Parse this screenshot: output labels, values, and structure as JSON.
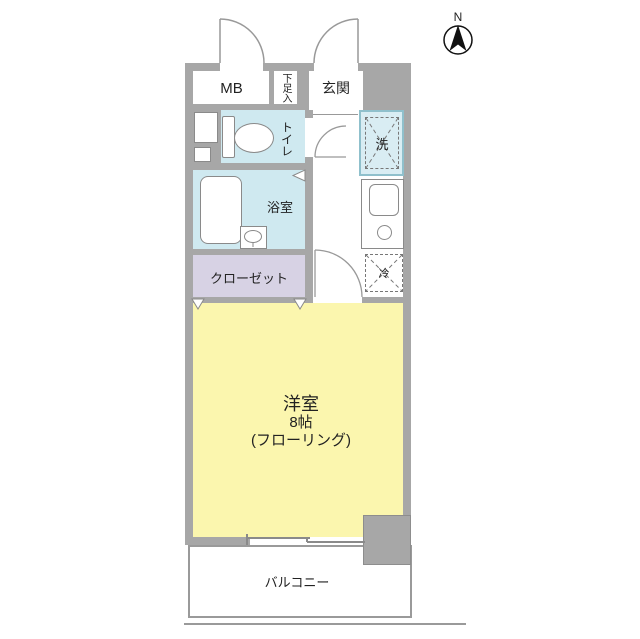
{
  "compass": {
    "north_label": "N"
  },
  "floor_plan": {
    "rooms": {
      "mb": {
        "label": "MB"
      },
      "shoe_box": {
        "label": "下足入"
      },
      "entrance": {
        "label": "玄関"
      },
      "toilet": {
        "label": "トイレ"
      },
      "bathroom": {
        "label": "浴室"
      },
      "laundry": {
        "label": "洗"
      },
      "refrigerator": {
        "label": "冷"
      },
      "closet": {
        "label": "クローゼット"
      },
      "western_room": {
        "label_line1": "洋室",
        "label_line2": "8帖",
        "label_line3": "(フローリング)"
      },
      "balcony": {
        "label": "バルコニー"
      }
    },
    "colors": {
      "wall": "#a7a7a7",
      "wet_area_floor": "#cfe9f0",
      "laundry_border": "#8fc0cc",
      "closet_floor": "#d7d2e4",
      "western_room_floor": "#fbf6ae",
      "outline": "#8a8a8a"
    }
  }
}
